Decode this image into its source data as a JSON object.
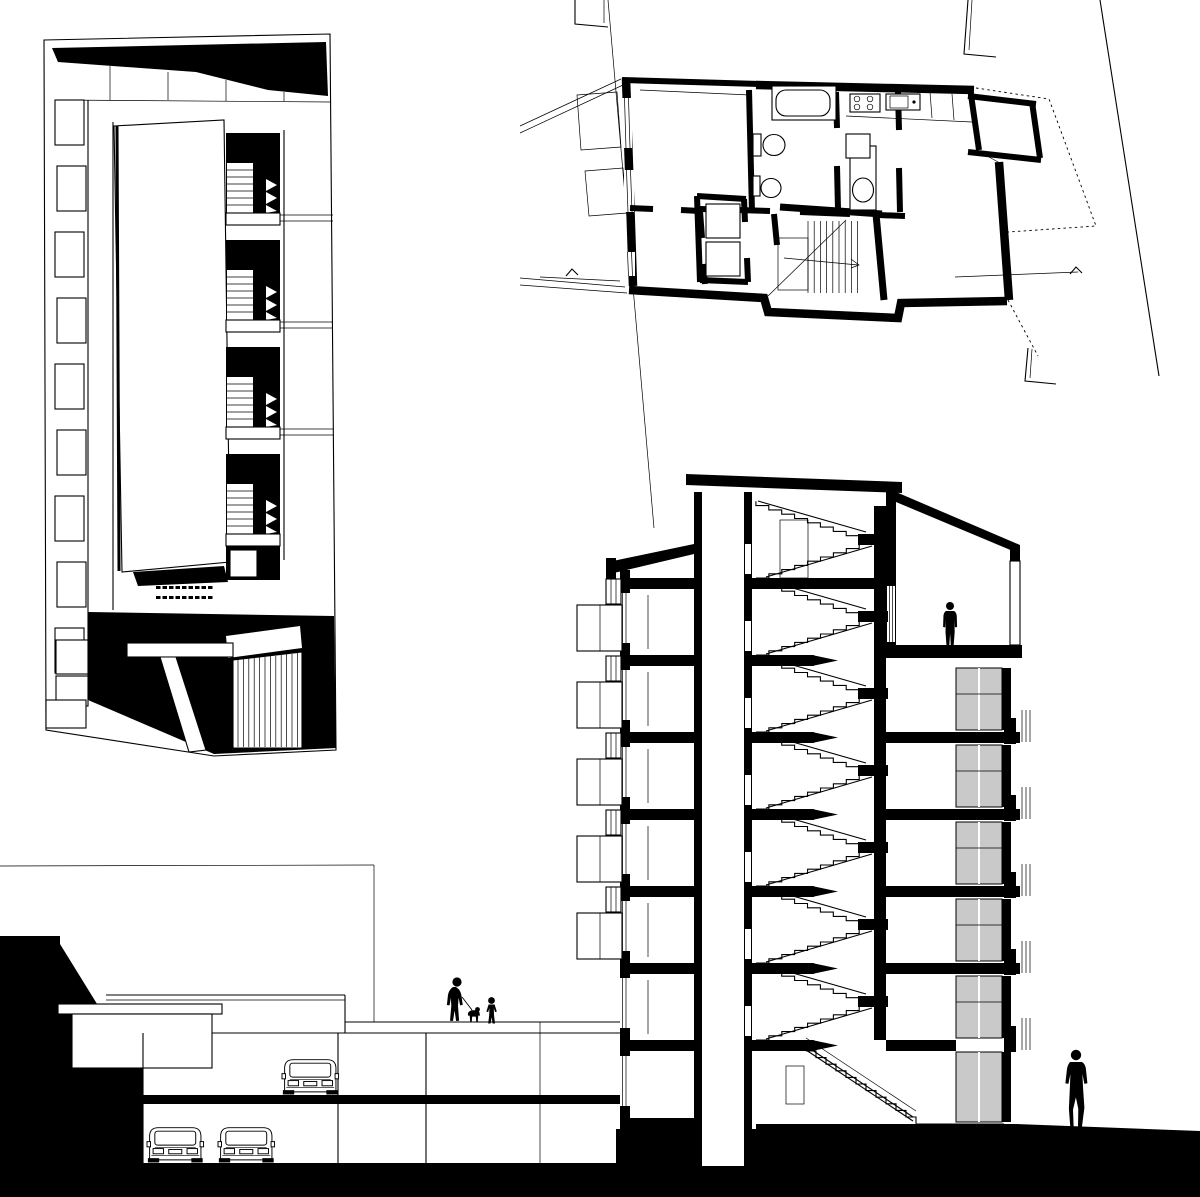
{
  "page": {
    "title": "Architectural drawing sheet"
  },
  "colors": {
    "ink": "#000000",
    "paper": "#ffffff",
    "glazing": "#c9c9c9"
  },
  "panels": {
    "axonometric": {
      "label": "Sectional axonometric of the apartment block",
      "stair_units": 4,
      "balcony_boxes": 9,
      "features": [
        "black roof plane",
        "courtyard void",
        "stacked stair flights",
        "entrance with louvered gate",
        "canopy"
      ]
    },
    "floor_plan": {
      "label": "Typical floor plan",
      "rooms": [
        "bedroom",
        "bathroom",
        "shower room",
        "kitchen",
        "living room",
        "hall"
      ],
      "fixtures": [
        "bathtub",
        "toilet",
        "bidet",
        "washbasin",
        "cooktop",
        "kitchen sink"
      ],
      "core": [
        "elevator",
        "dog-leg stair with up arrow"
      ],
      "section_markers": 2,
      "context": [
        "site boundary diagonals",
        "neighbouring building corners",
        "balcony outlines"
      ]
    },
    "section": {
      "label": "Cross section through building, plaza deck and underground garage",
      "floors_above_entry": 7,
      "parking_levels": 2,
      "cars": 3,
      "figures": [
        "woman with dog on leash",
        "child",
        "man on roof terrace",
        "man on street"
      ],
      "elements": [
        "elevator shaft",
        "scissor stairs",
        "stair bulkhead",
        "sloped roofs",
        "balconies",
        "glazed sliding doors",
        "roof terrace",
        "entrance stair",
        "plaza deck",
        "kiosk",
        "ground poché"
      ]
    }
  }
}
